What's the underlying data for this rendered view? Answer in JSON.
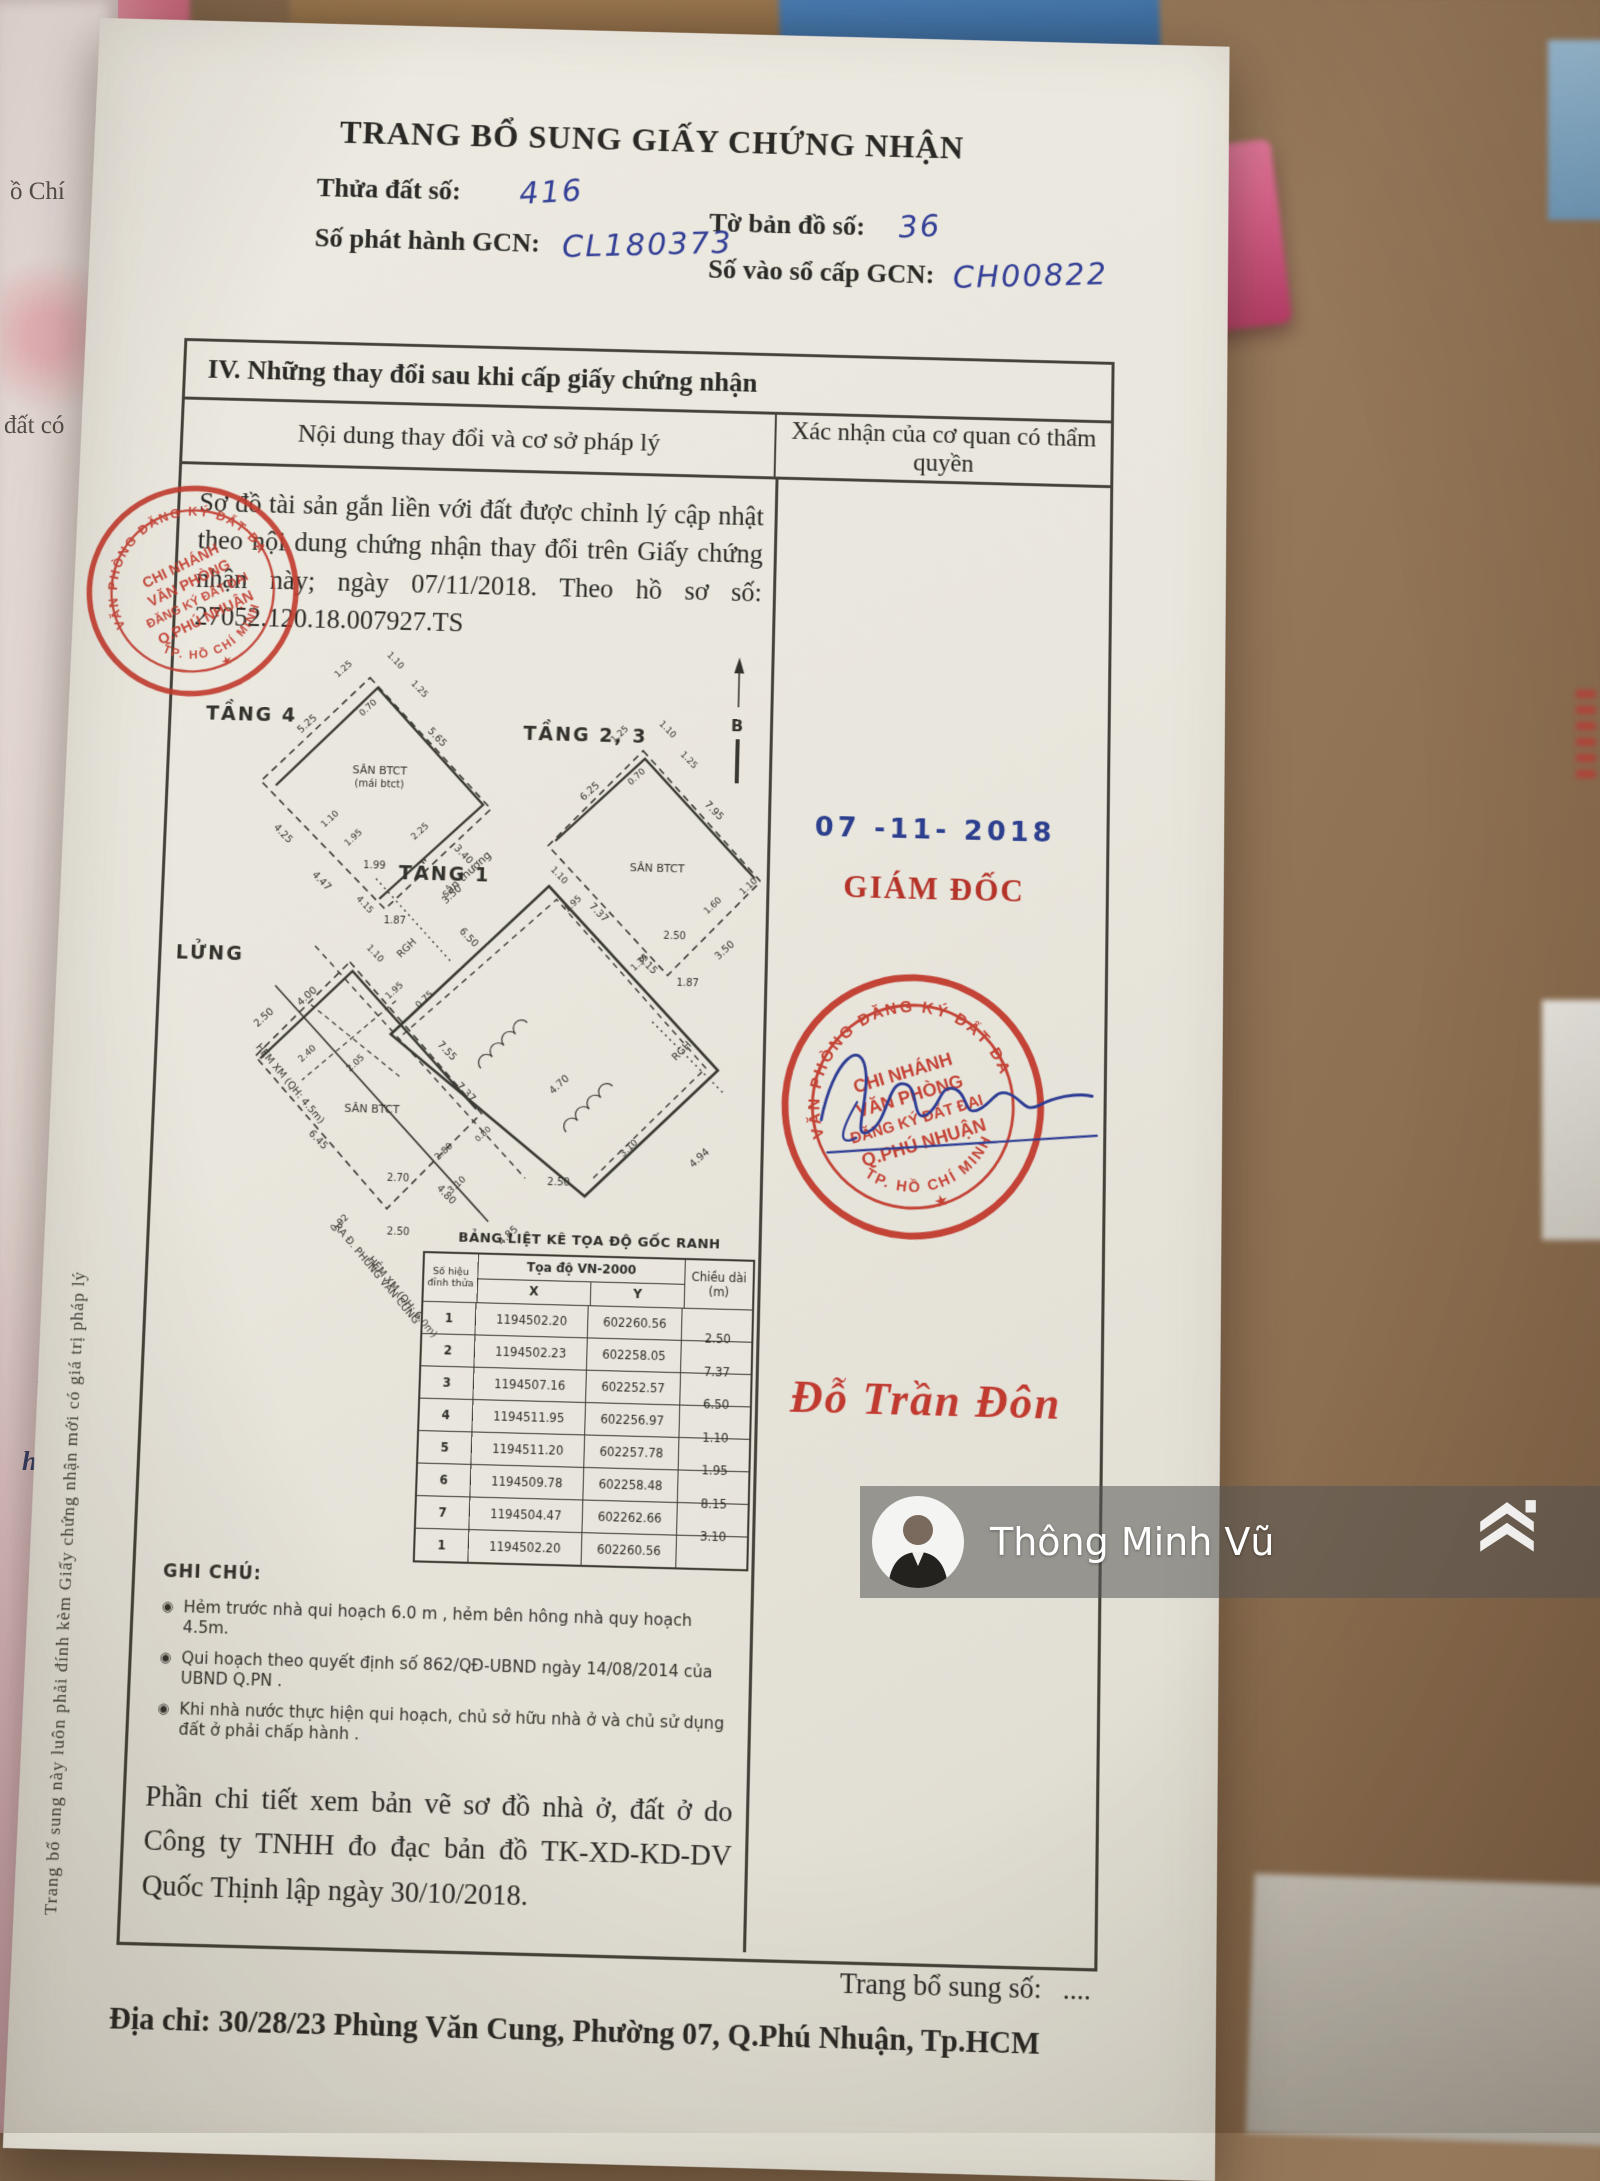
{
  "header": {
    "title": "TRANG BỔ SUNG GIẤY CHỨNG NHẬN",
    "fields": [
      {
        "label": "Thửa đất số:",
        "value": "416"
      },
      {
        "label": "Tờ bản đồ số:",
        "value": "36"
      },
      {
        "label": "Số phát hành GCN:",
        "value": "CL180373"
      },
      {
        "label": "Số vào sổ cấp GCN:",
        "value": "CH00822"
      }
    ]
  },
  "section": {
    "heading": "IV. Những thay đổi sau khi cấp giấy chứng nhận",
    "col_left": "Nội dung thay đổi và cơ sở pháp lý",
    "col_right": "Xác nhận của cơ quan có thẩm quyền"
  },
  "body": {
    "paragraph": "Sơ đồ tài sản gắn liền với đất được chỉnh lý cập nhật theo nội dung chứng nhận thay đổi trên Giấy chứng nhận này; ngày 07/11/2018. Theo hồ sơ số: 27052.120.18.007927.TS",
    "closing": "Phần chi tiết xem bản vẽ sơ đồ nhà ở, đất ở do Công ty TNHH đo đạc bản đồ TK-XD-KD-DV Quốc Thịnh lập ngày 30/10/2018."
  },
  "notes": {
    "title": "GHI CHÚ:",
    "bullet": "◉",
    "items": [
      "Hẻm trước nhà qui hoạch 6.0 m , hẻm bên hông nhà quy hoạch 4.5m.",
      "Qui hoạch theo quyết định số 862/QĐ-UBND ngày 14/08/2014 của UBND Q.PN .",
      "Khi nhà nước thực hiện qui hoạch, chủ sở hữu nhà ở và chủ sử dụng đất ở phải chấp hành ."
    ]
  },
  "coords_table": {
    "title": "BẢNG LIỆT KÊ TỌA ĐỘ GỐC RANH",
    "h_point1": "Số hiệu",
    "h_point2": "đỉnh thửa",
    "h_group": "Tọa độ VN-2000",
    "h_x": "X",
    "h_y": "Y",
    "h_len1": "Chiều dài",
    "h_len2": "(m)",
    "rows": [
      [
        "1",
        "1194502.20",
        "602260.56"
      ],
      [
        "2",
        "1194502.23",
        "602258.05"
      ],
      [
        "3",
        "1194507.16",
        "602252.57"
      ],
      [
        "4",
        "1194511.95",
        "602256.97"
      ],
      [
        "5",
        "1194511.20",
        "602257.78"
      ],
      [
        "6",
        "1194509.78",
        "602258.48"
      ],
      [
        "7",
        "1194504.47",
        "602262.66"
      ],
      [
        "1",
        "1194502.20",
        "602260.56"
      ]
    ],
    "lengths": [
      "2.50",
      "7.37",
      "6.50",
      "1.10",
      "1.95",
      "8.15",
      "3.10"
    ]
  },
  "approval": {
    "date_stamp": "07 -11- 2018",
    "role": "GIÁM ĐỐC",
    "signer": "Đỗ Trần Đôn",
    "stamp": {
      "arc_top": "VĂN PHÒNG ĐĂNG KÝ ĐẤT ĐAI",
      "arc_bottom": "TP. HỒ CHÍ MINH",
      "line1": "CHI NHÁNH",
      "line2": "VĂN PHÒNG",
      "line3": "ĐĂNG KÝ ĐẤT ĐAI",
      "line4": "Q.PHÚ NHUẬN",
      "star": "★"
    }
  },
  "footer": {
    "page_no_label": "Trang bổ sung số:",
    "page_no_value": "....",
    "address": "Địa chỉ: 30/28/23 Phùng Văn Cung, Phường 07, Q.Phú Nhuận, Tp.HCM"
  },
  "margin_note": "Trang bổ sung này luôn phải đính kèm Giấy chứng nhận mới có giá trị pháp lý",
  "watermark": {
    "name": "Thông Minh Vũ"
  },
  "background_texts": {
    "t1": "ồ Chí",
    "t2": "đất có",
    "hw1": "n 201",
    "hw2": "huận"
  },
  "diagram": {
    "texts": [
      {
        "t": "TẦNG 4",
        "x": 78,
        "y": 98,
        "s": 19,
        "b": 1
      },
      {
        "t": "TẦNG 2, 3",
        "x": 412,
        "y": 110,
        "s": 19,
        "b": 1
      },
      {
        "t": "TẦNG 1",
        "x": 276,
        "y": 252,
        "s": 19,
        "b": 1
      },
      {
        "t": "LỬNG",
        "x": 46,
        "y": 336,
        "s": 19,
        "b": 1
      },
      {
        "t": "B",
        "x": 564,
        "y": 96,
        "s": 16,
        "b": 1
      },
      {
        "t": "SÂN BTCT",
        "x": 208,
        "y": 148,
        "s": 11
      },
      {
        "t": "(mái btct)",
        "x": 208,
        "y": 161,
        "s": 10
      },
      {
        "t": "sân thượng",
        "x": 300,
        "y": 248,
        "r": -44,
        "s": 11
      },
      {
        "t": "SÂN BTCT",
        "x": 487,
        "y": 238,
        "s": 11
      },
      {
        "t": "SÂN BTCT",
        "x": 212,
        "y": 482,
        "s": 11
      },
      {
        "t": "HẺM XM (QH: 4.5m)",
        "x": 128,
        "y": 458,
        "r": 48,
        "s": 10
      },
      {
        "t": "RA Đ. PHÙNG VĂN CUNG",
        "x": 220,
        "y": 640,
        "r": 48,
        "s": 10
      },
      {
        "t": "HẺM XM (QH: 6.0m)",
        "x": 246,
        "y": 662,
        "r": 48,
        "s": 10
      },
      {
        "t": "RGH",
        "x": 243,
        "y": 322,
        "r": -46,
        "s": 10
      },
      {
        "t": "RGH",
        "x": 518,
        "y": 416,
        "r": -46,
        "s": 10
      },
      {
        "t": "1.25",
        "x": 170,
        "y": 46,
        "r": -44,
        "s": 9
      },
      {
        "t": "1.10",
        "x": 218,
        "y": 36,
        "r": 44,
        "s": 9
      },
      {
        "t": "1.25",
        "x": 243,
        "y": 64,
        "r": 44,
        "s": 9
      },
      {
        "t": "0.70",
        "x": 196,
        "y": 84,
        "r": -44,
        "s": 9
      },
      {
        "t": "5.25",
        "x": 136,
        "y": 102,
        "r": -44,
        "s": 10
      },
      {
        "t": "5.65",
        "x": 262,
        "y": 112,
        "r": 44,
        "s": 10
      },
      {
        "t": "4.25",
        "x": 112,
        "y": 212,
        "r": 44,
        "s": 10
      },
      {
        "t": "3.40",
        "x": 292,
        "y": 228,
        "r": 44,
        "s": 10
      },
      {
        "t": "1.10",
        "x": 162,
        "y": 196,
        "r": -44,
        "s": 9
      },
      {
        "t": "1.95",
        "x": 186,
        "y": 214,
        "r": -44,
        "s": 9
      },
      {
        "t": "1.99",
        "x": 206,
        "y": 242,
        "s": 10
      },
      {
        "t": "2.25",
        "x": 252,
        "y": 206,
        "r": -44,
        "s": 9
      },
      {
        "t": "4.47",
        "x": 152,
        "y": 258,
        "r": 44,
        "s": 10
      },
      {
        "t": "3.50",
        "x": 286,
        "y": 268,
        "r": -44,
        "s": 10
      },
      {
        "t": "1.87",
        "x": 228,
        "y": 296,
        "s": 10
      },
      {
        "t": "6.25",
        "x": 420,
        "y": 162,
        "r": -44,
        "s": 10
      },
      {
        "t": "1.25",
        "x": 448,
        "y": 104,
        "r": -44,
        "s": 9
      },
      {
        "t": "1.10",
        "x": 492,
        "y": 98,
        "r": 44,
        "s": 9
      },
      {
        "t": "1.25",
        "x": 514,
        "y": 128,
        "r": 44,
        "s": 9
      },
      {
        "t": "0.70",
        "x": 466,
        "y": 146,
        "r": -44,
        "s": 9
      },
      {
        "t": "7.95",
        "x": 540,
        "y": 178,
        "r": 44,
        "s": 10
      },
      {
        "t": "7.37",
        "x": 428,
        "y": 282,
        "r": 44,
        "s": 10
      },
      {
        "t": "2.50",
        "x": 506,
        "y": 304,
        "s": 10
      },
      {
        "t": "1.60",
        "x": 545,
        "y": 272,
        "r": -44,
        "s": 9
      },
      {
        "t": "1.10",
        "x": 580,
        "y": 252,
        "r": -44,
        "s": 9
      },
      {
        "t": "1.35",
        "x": 474,
        "y": 330,
        "r": -44,
        "s": 9
      },
      {
        "t": "3.50",
        "x": 558,
        "y": 316,
        "r": -44,
        "s": 10
      },
      {
        "t": "1.87",
        "x": 520,
        "y": 350,
        "s": 10
      },
      {
        "t": "6.50",
        "x": 300,
        "y": 310,
        "r": 44,
        "s": 10
      },
      {
        "t": "1.10",
        "x": 388,
        "y": 246,
        "r": 44,
        "s": 9
      },
      {
        "t": "1.95",
        "x": 406,
        "y": 274,
        "r": -44,
        "s": 9
      },
      {
        "t": "8.15",
        "x": 478,
        "y": 332,
        "r": 44,
        "s": 10
      },
      {
        "t": "0.75",
        "x": 262,
        "y": 372,
        "r": -44,
        "s": 9
      },
      {
        "t": "4.15",
        "x": 196,
        "y": 280,
        "r": 44,
        "s": 9
      },
      {
        "t": "7.37",
        "x": 302,
        "y": 462,
        "r": 44,
        "s": 10
      },
      {
        "t": "4.70",
        "x": 398,
        "y": 452,
        "r": -44,
        "s": 10
      },
      {
        "t": "3.10",
        "x": 468,
        "y": 512,
        "r": -44,
        "s": 9
      },
      {
        "t": "2.50",
        "x": 398,
        "y": 548,
        "s": 10
      },
      {
        "t": "4.80",
        "x": 286,
        "y": 562,
        "r": 44,
        "s": 10
      },
      {
        "t": "4.85",
        "x": 352,
        "y": 600,
        "r": -44,
        "s": 10
      },
      {
        "t": "4.94",
        "x": 538,
        "y": 520,
        "r": -44,
        "s": 10
      },
      {
        "t": "1.10",
        "x": 208,
        "y": 328,
        "r": 44,
        "s": 9
      },
      {
        "t": "4.00",
        "x": 146,
        "y": 372,
        "r": -44,
        "s": 10
      },
      {
        "t": "1.95",
        "x": 232,
        "y": 364,
        "r": -44,
        "s": 9
      },
      {
        "t": "2.50",
        "x": 104,
        "y": 394,
        "r": -44,
        "s": 10
      },
      {
        "t": "2.40",
        "x": 148,
        "y": 428,
        "r": -44,
        "s": 9
      },
      {
        "t": "2.05",
        "x": 196,
        "y": 436,
        "r": -44,
        "s": 9
      },
      {
        "t": "7.55",
        "x": 282,
        "y": 422,
        "r": 44,
        "s": 10
      },
      {
        "t": "6.45",
        "x": 158,
        "y": 512,
        "r": 44,
        "s": 10
      },
      {
        "t": "2.80",
        "x": 286,
        "y": 520,
        "r": -44,
        "s": 9
      },
      {
        "t": "2.70",
        "x": 240,
        "y": 548,
        "s": 10
      },
      {
        "t": "3.10",
        "x": 300,
        "y": 552,
        "r": -44,
        "s": 9
      },
      {
        "t": "0.80",
        "x": 324,
        "y": 502,
        "r": -44,
        "s": 8
      },
      {
        "t": "0.92",
        "x": 186,
        "y": 592,
        "r": -44,
        "s": 9
      },
      {
        "t": "2.50",
        "x": 242,
        "y": 600,
        "s": 10
      }
    ]
  }
}
